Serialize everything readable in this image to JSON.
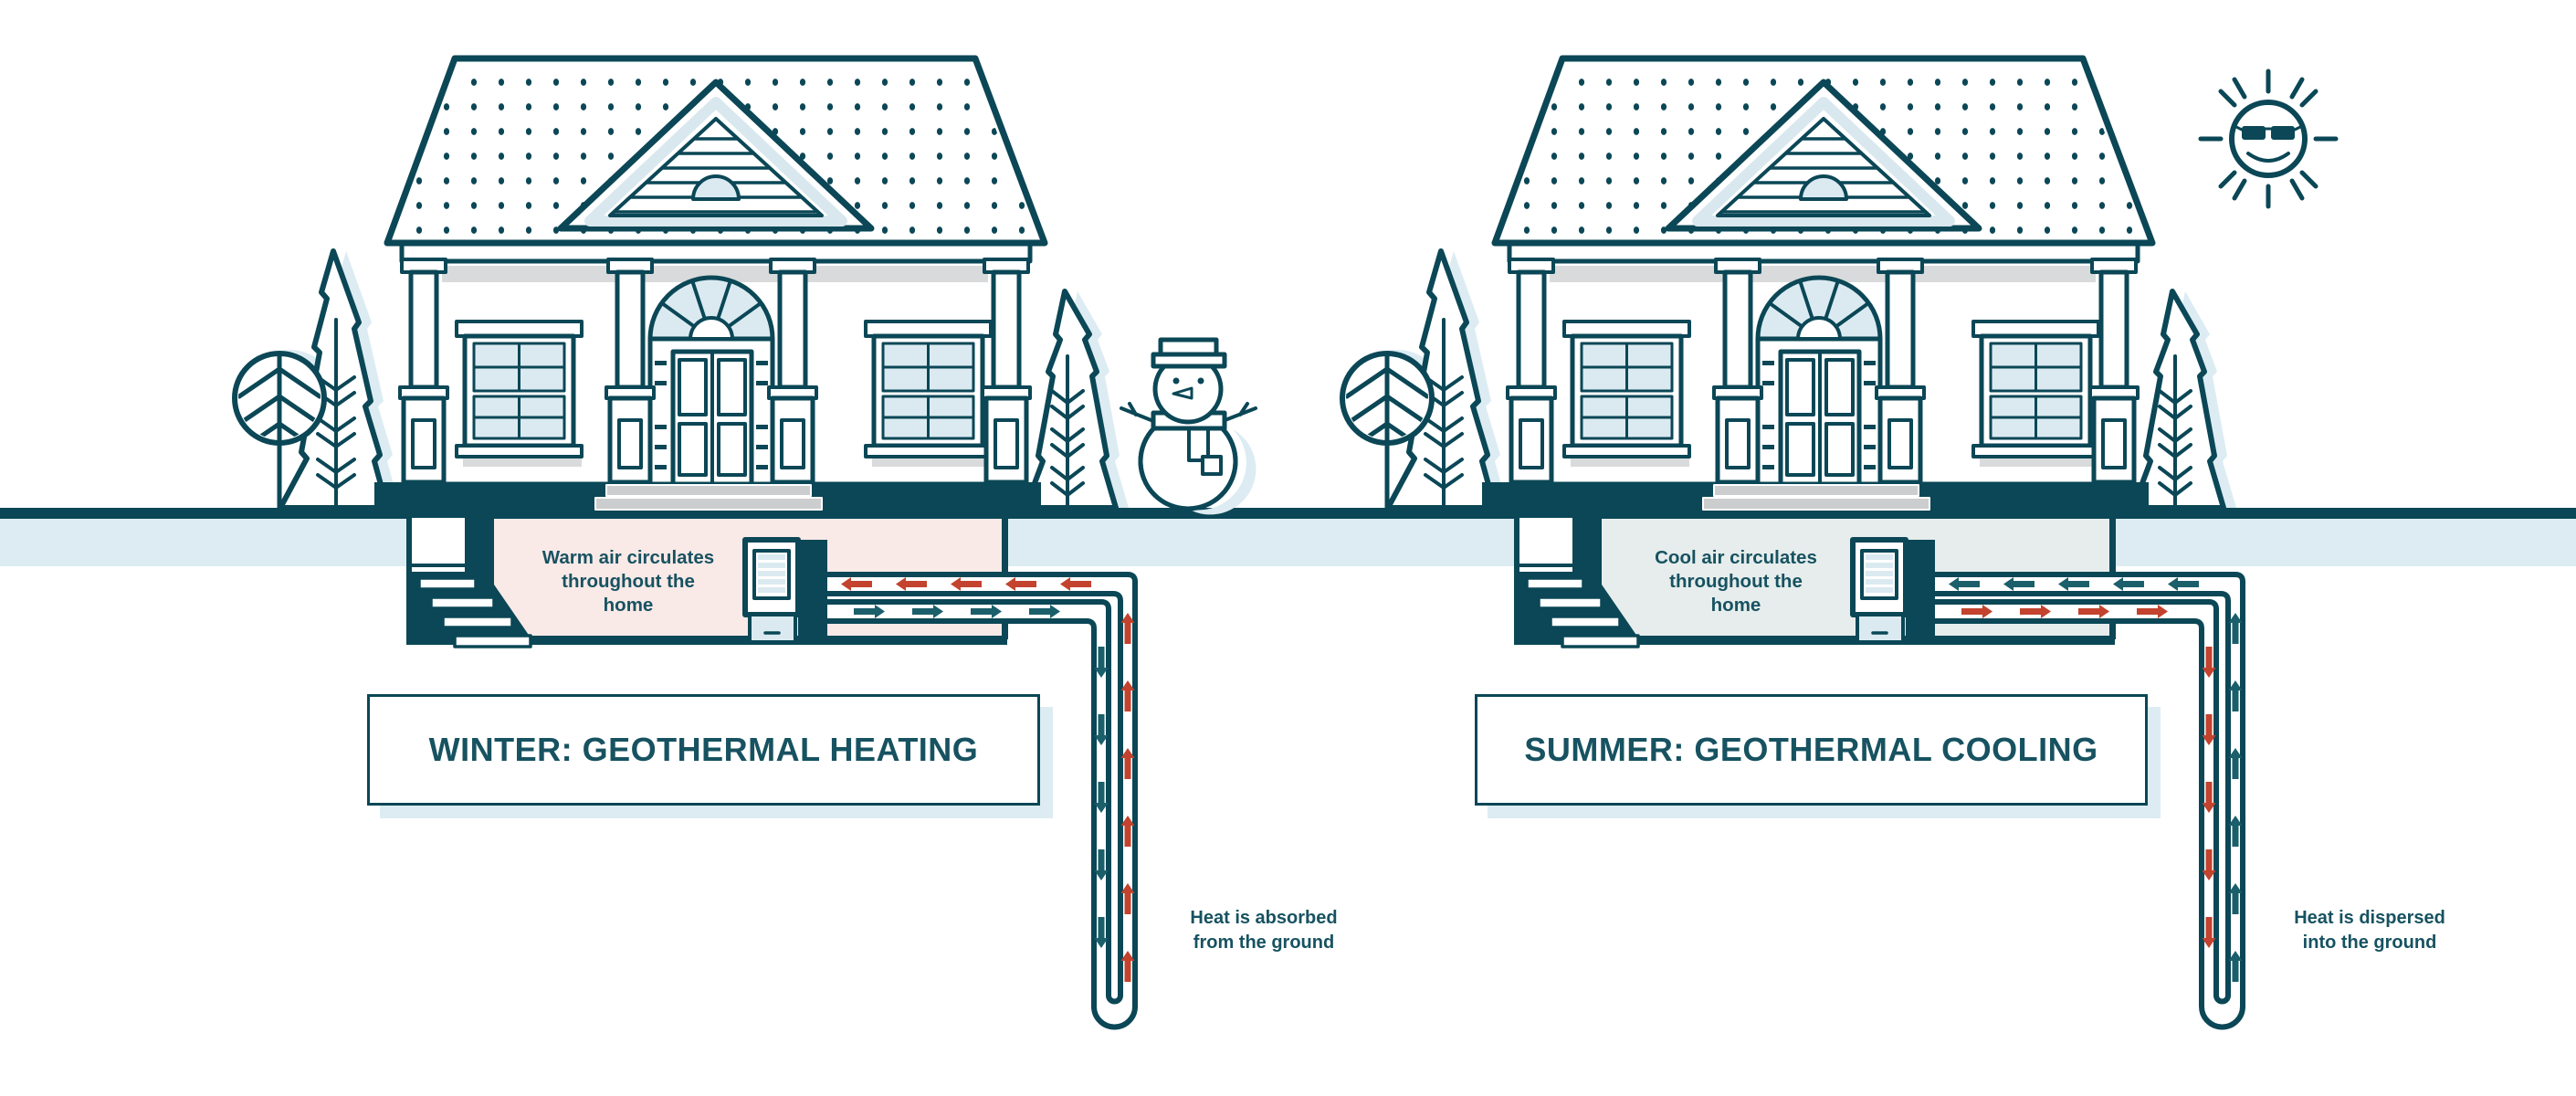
{
  "winter": {
    "title": "WINTER: GEOTHERMAL HEATING",
    "basement_label": {
      "line1": "Warm air circulates",
      "line2": "throughout the",
      "line3": "home"
    },
    "ground_label": {
      "line1": "Heat is absorbed",
      "line2": "from the ground"
    },
    "mascot_icon": "snowman-icon"
  },
  "summer": {
    "title": "SUMMER: GEOTHERMAL COOLING",
    "basement_label": {
      "line1": "Cool air circulates",
      "line2": "throughout the",
      "line3": "home"
    },
    "ground_label": {
      "line1": "Heat is dispersed",
      "line2": "into the ground"
    },
    "mascot_icon": "sun-icon"
  },
  "palette": {
    "ink": "#0b4756",
    "text": "#175261",
    "warm_red": "#c3432e",
    "cool_teal": "#1b5f6b",
    "ground_band_blue": "#dcecf2",
    "winter_room_pink": "#f9e9e7",
    "summer_room_gray": "#e6edec",
    "window_glass": "#dbeaf1",
    "step_gray": "#cbcdce"
  }
}
